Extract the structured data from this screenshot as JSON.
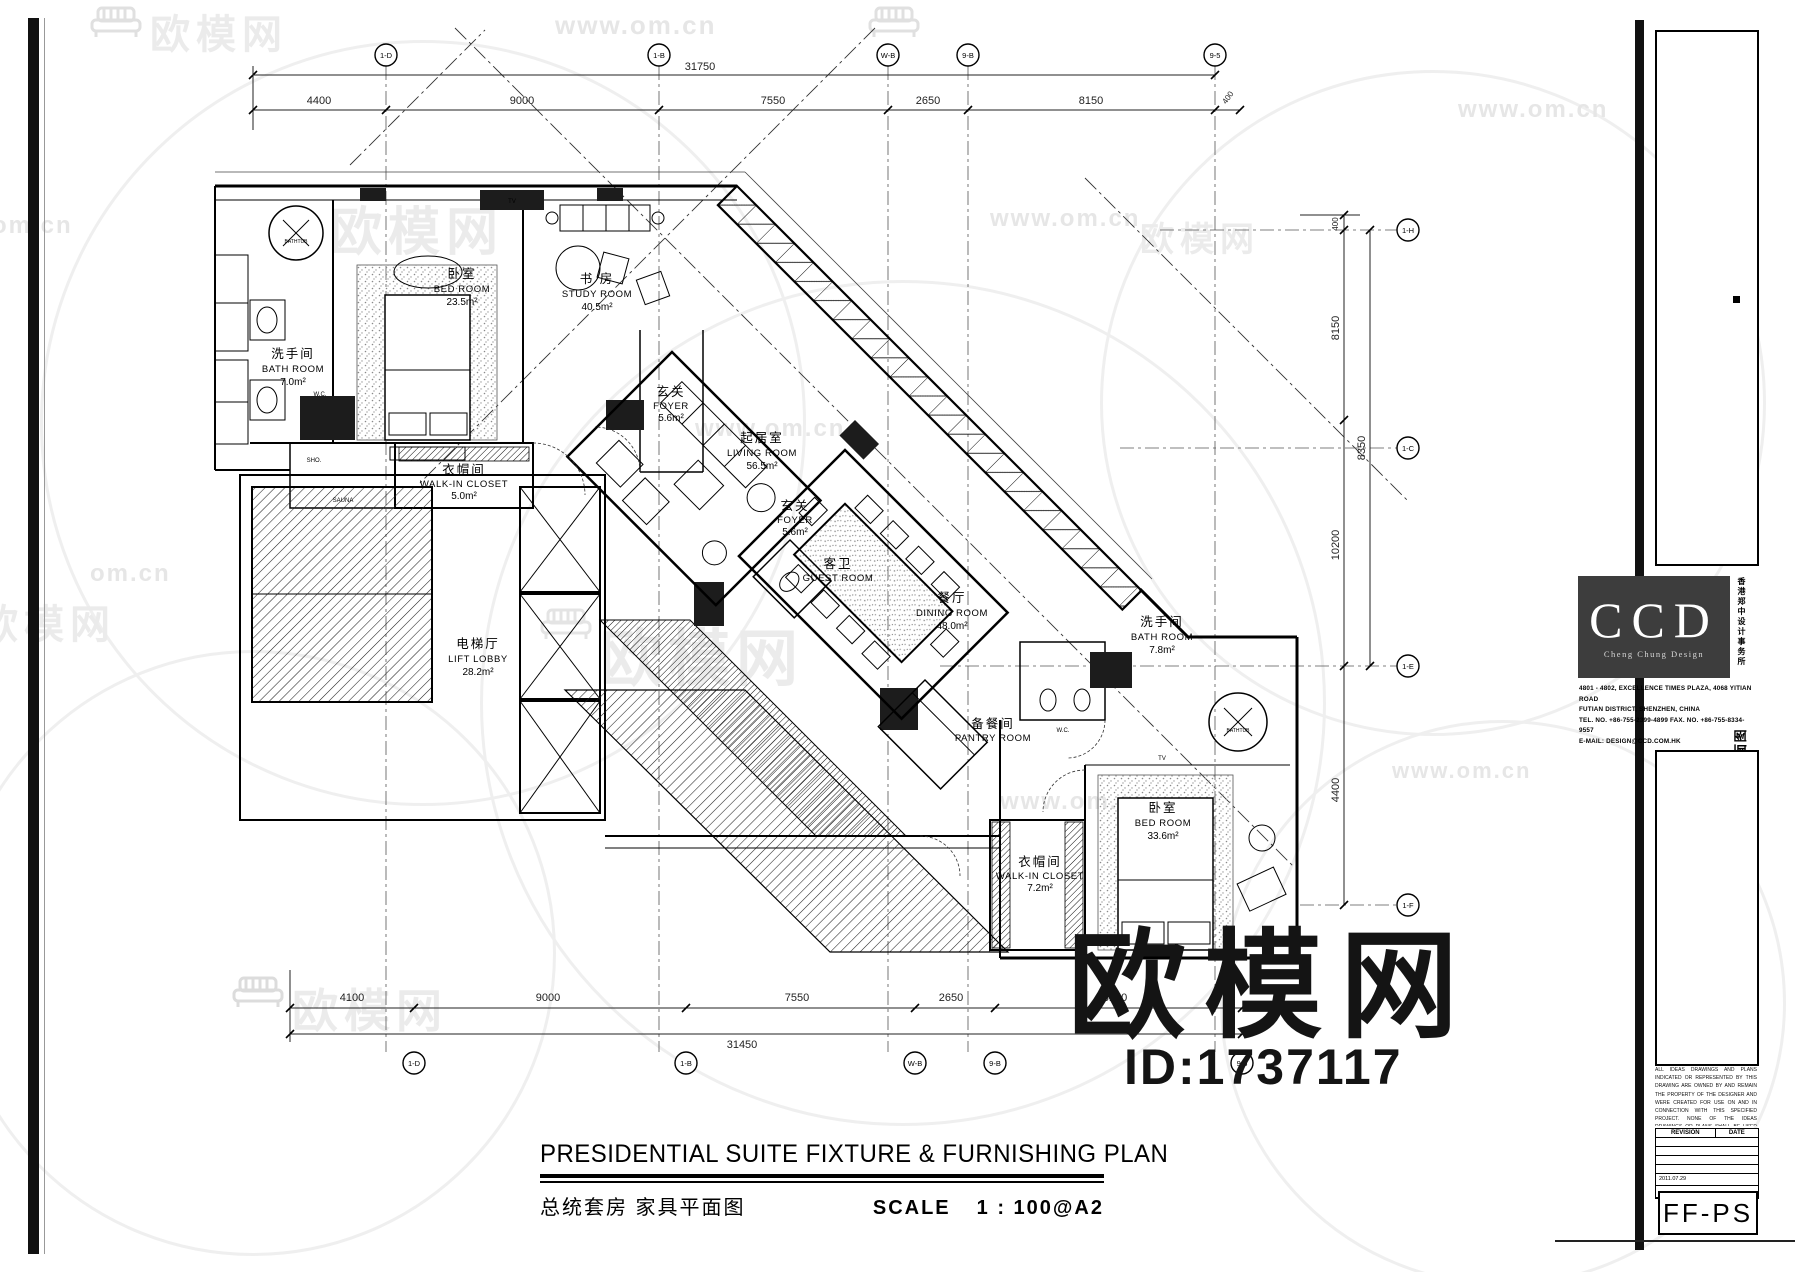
{
  "watermarks": {
    "url": "www.om.cn",
    "url_short": "om.cn",
    "brand": "欧模网",
    "big_text": "欧模网",
    "big_id": "ID:1737117"
  },
  "title_block": {
    "hotel_cn": "广州万达希尔顿酒店",
    "hotel_en": "GUANGZHOU WANDA HILTON HOTEL",
    "location_en": "GUANGZHOU , CHINA",
    "ccd_logo": "CCD",
    "ccd_subtitle": "Cheng Chung Design",
    "ccd_side_cn": "香港郑中设计事务所",
    "ccd_address_1": "4801 - 4802, EXCELLENCE TIMES PLAZA, 4068 YITIAN ROAD",
    "ccd_address_2": "FUTIAN DISTRICT, SHENZHEN, CHINA",
    "ccd_address_3": "TEL. NO. +86-755-2399-4899    FAX. NO. +86-755-8334-9557",
    "ccd_address_4": "E-MAIL: DESIGN@CCD.COM.HK",
    "area_en": "GUEST ROOMS AREA",
    "area_cn": "客房部分",
    "level_en": "LEVEL 08",
    "level_cn": "八层",
    "sheet_en": "FIXTURE & FURNISHING PLAN",
    "sheet_cn": "家具平面图",
    "disclaimer": "ALL IDEAS DRAWINGS AND PLANS INDICATED OR REPRESENTED BY THIS DRAWING ARE OWNED BY AND REMAIN THE PROPERTY OF THE DESIGNER AND WERE CREATED FOR USE ON AND IN CONNECTION WITH THIS SPECIFIED PROJECT. NONE OF THE IDEAS DRAWINGS OR PLANS SHALL BE USED OR DISCLOSED TO ANY PERSON FIRM OR CORPORATION WITHOUT THE WRITTEN PERMISSION OF THE DESIGNER AND NOT TO BE USED ON ANY OTHER PROJECT.",
    "revision_label": "REVISION",
    "date_label": "DATE",
    "field_date": "2011.07.29",
    "drawing_no": "FF-PS"
  },
  "footer": {
    "title_en": "PRESIDENTIAL SUITE FIXTURE & FURNISHING PLAN",
    "title_cn": "总统套房 家具平面图",
    "scale_label": "SCALE",
    "scale_value": "1 : 100@A2"
  },
  "rooms": [
    {
      "cn": "洗手间",
      "en": "BATH ROOM",
      "area": "7.0m²"
    },
    {
      "cn": "卧室",
      "en": "BED ROOM",
      "area": "23.5m²"
    },
    {
      "cn": "书 房",
      "en": "STUDY ROOM",
      "area": "40.5m²"
    },
    {
      "cn": "衣帽间",
      "en": "WALK-IN CLOSET",
      "area": "5.0m²"
    },
    {
      "cn": "玄关",
      "en": "FOYER",
      "area": "5.6m²"
    },
    {
      "cn": "玄关",
      "en": "FOYER",
      "area": "5.6m²"
    },
    {
      "cn": "起居室",
      "en": "LIVING ROOM",
      "area": "56.5m²"
    },
    {
      "cn": "餐厅",
      "en": "DINING ROOM",
      "area": "48.0m²"
    },
    {
      "cn": "电梯厅",
      "en": "LIFT LOBBY",
      "area": "28.2m²"
    },
    {
      "cn": "客卫",
      "en": "GUEST ROOM",
      "area": ""
    },
    {
      "cn": "备餐间",
      "en": "PANTRY ROOM",
      "area": ""
    },
    {
      "cn": "洗手间",
      "en": "BATH ROOM",
      "area": "7.8m²"
    },
    {
      "cn": "卧室",
      "en": "BED ROOM",
      "area": "33.6m²"
    },
    {
      "cn": "衣帽间",
      "en": "WALK-IN CLOSET",
      "area": "7.2m²"
    }
  ],
  "small_labels": {
    "sauna": "SAUNA",
    "sho": "SHO.",
    "wc": "W.C.",
    "bathtub": "BATHTUB",
    "tv": "TV"
  },
  "dims": {
    "top_total": "31750",
    "top": [
      "4400",
      "9000",
      "7550",
      "2650",
      "8150"
    ],
    "top_small": "400",
    "bottom": [
      "4100",
      "9000",
      "7550",
      "2650",
      "8150"
    ],
    "bottom_total": "31450",
    "right": [
      "8150",
      "8350",
      "10200",
      "4400"
    ],
    "right_small": "400"
  },
  "grid": {
    "top": [
      "1-D",
      "1-B",
      "W-B",
      "9-B",
      "9-5"
    ],
    "bottom": [
      "1-D",
      "1-B",
      "W-B",
      "9-B",
      "9-5"
    ],
    "right": [
      "1-H",
      "1-C",
      "1-E",
      "1-F"
    ]
  }
}
